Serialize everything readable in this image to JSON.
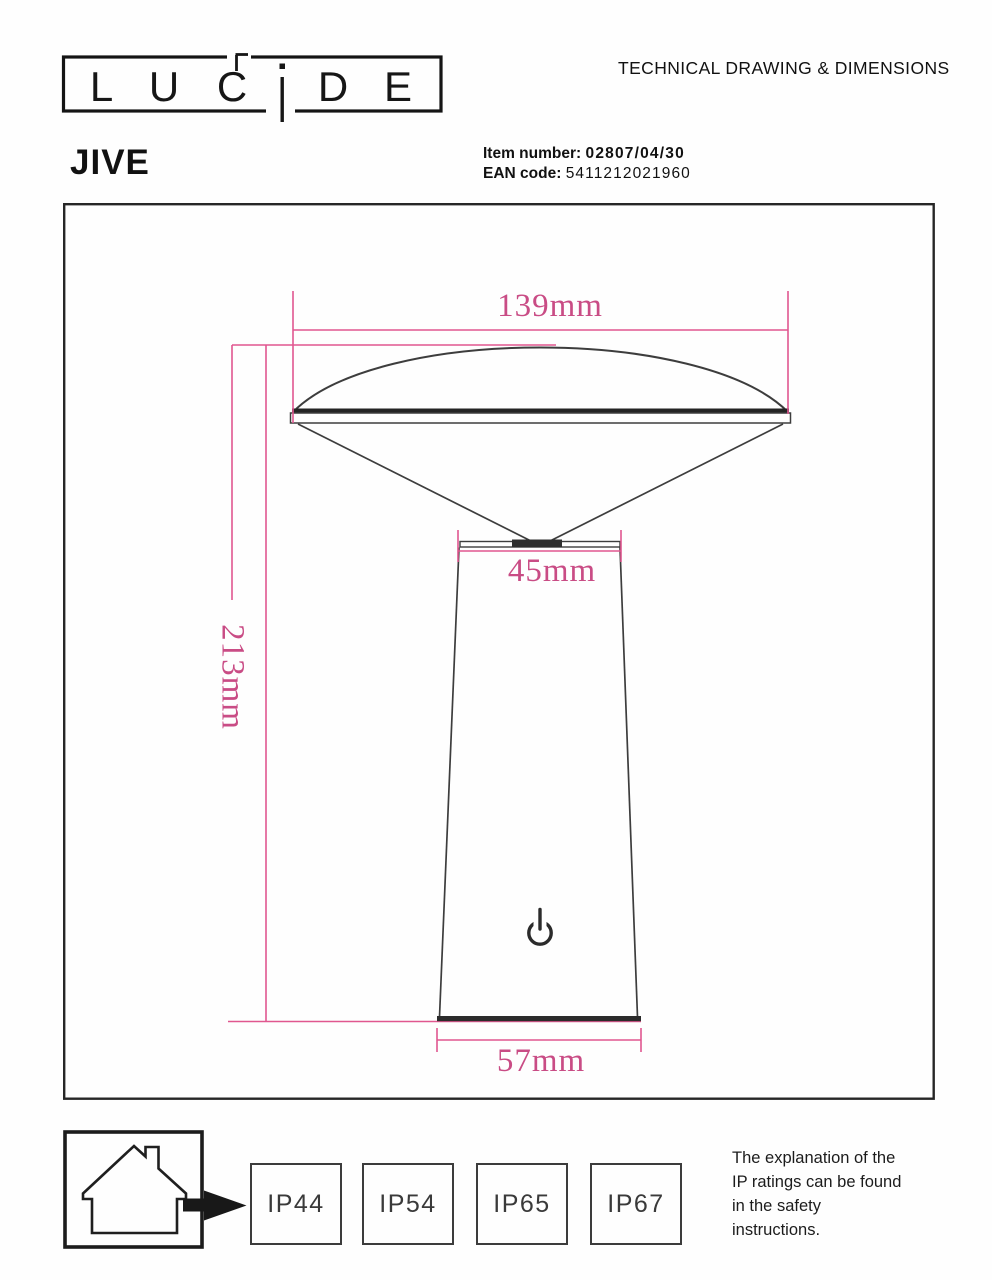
{
  "brand": {
    "name": "LUCIDE",
    "letters": [
      "L",
      "U",
      "C",
      "D",
      "E"
    ]
  },
  "header": {
    "doc_title": "TECHNICAL DRAWING & DIMENSIONS",
    "product_name": "JIVE",
    "item_number_label": "Item number:",
    "item_number_value": "02807/04/30",
    "ean_label": "EAN code:",
    "ean_value": "5411212021960"
  },
  "drawing": {
    "type": "technical-dimension-drawing",
    "subject": "table lamp side profile",
    "dimensions": {
      "shade_width": "139mm",
      "neck_width": "45mm",
      "total_height": "213mm",
      "base_width": "57mm"
    },
    "icons": {
      "power_button": "power-symbol"
    },
    "colors": {
      "dimension_pink_line": "#e0578f",
      "dimension_pink_text": "#c94c85",
      "outline_dark": "#3d3d3d"
    }
  },
  "footer": {
    "indoor_icon": "house-indoor-use",
    "ip_ratings": [
      "IP44",
      "IP54",
      "IP65",
      "IP67"
    ],
    "note_lines": [
      "The explanation of the",
      "IP ratings can be found",
      "in the safety",
      "instructions."
    ]
  }
}
